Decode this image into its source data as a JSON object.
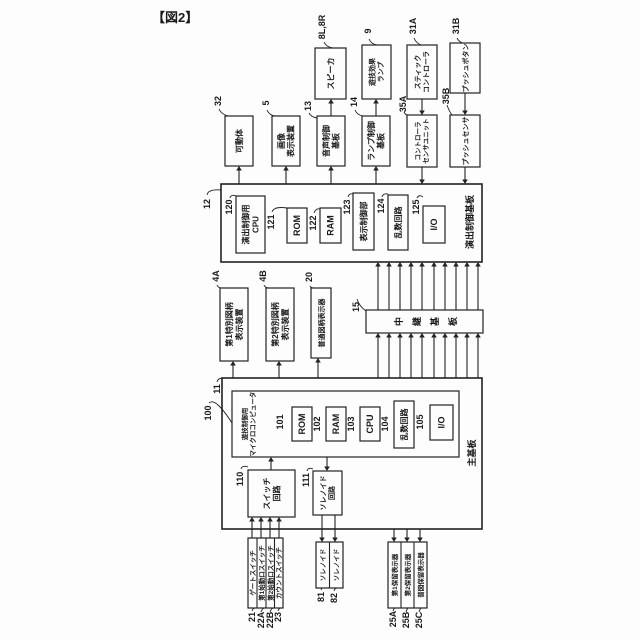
{
  "title": "【図2】",
  "nodes": {
    "speaker": {
      "ref": "8L,8R",
      "lines": [
        "スピーカ"
      ]
    },
    "effect_lamp": {
      "ref": "9",
      "lines": [
        "遊技効果",
        "ランプ"
      ]
    },
    "stick_controller": {
      "ref": "31A",
      "lines": [
        "スティック",
        "コントローラ"
      ]
    },
    "push_button": {
      "ref": "31B",
      "lines": [
        "プッシュボタン"
      ]
    },
    "movable_body": {
      "ref": "32",
      "lines": [
        "可動体"
      ]
    },
    "image_display": {
      "ref": "5",
      "lines": [
        "画像",
        "表示装置"
      ]
    },
    "sound_board": {
      "ref": "13",
      "lines": [
        "音声制御",
        "基板"
      ]
    },
    "lamp_board": {
      "ref": "14",
      "lines": [
        "ランプ制御",
        "基板"
      ]
    },
    "controller_sensor": {
      "ref": "35A",
      "lines": [
        "コントローラ",
        "センサユニット"
      ]
    },
    "push_sensor": {
      "ref": "35B",
      "lines": [
        "プッシュセンサ"
      ]
    },
    "effect_board": {
      "ref": "12",
      "label": "演出制御基板"
    },
    "effect_cpu": {
      "ref": "120",
      "lines": [
        "演出制御用",
        "CPU"
      ]
    },
    "rom121": {
      "ref": "121",
      "label": "ROM"
    },
    "ram122": {
      "ref": "122",
      "label": "RAM"
    },
    "display_ctrl": {
      "ref": "123",
      "label": "表示制御部"
    },
    "random124": {
      "ref": "124",
      "label": "乱数回路"
    },
    "io125": {
      "ref": "125",
      "label": "I/O"
    },
    "sp1_display": {
      "ref": "4A",
      "lines": [
        "第1特別図柄",
        "表示装置"
      ]
    },
    "sp2_display": {
      "ref": "4B",
      "lines": [
        "第2特別図柄",
        "表示装置"
      ]
    },
    "normal_display": {
      "ref": "20",
      "label": "普通図柄表示器"
    },
    "relay_board": {
      "ref": "15",
      "label": "中継基板"
    },
    "main_board": {
      "ref": "11",
      "label": "主基板"
    },
    "game_micom": {
      "ref": "100",
      "lines": [
        "遊技制御用",
        "マイクロコンピュータ"
      ]
    },
    "rom101": {
      "ref": "101",
      "label": "ROM"
    },
    "ram102": {
      "ref": "102",
      "label": "RAM"
    },
    "cpu103": {
      "ref": "103",
      "label": "CPU"
    },
    "random104": {
      "ref": "104",
      "label": "乱数回路"
    },
    "io105": {
      "ref": "105",
      "label": "I/O"
    },
    "switch_circuit": {
      "ref": "110",
      "lines": [
        "スイッチ",
        "回路"
      ]
    },
    "solenoid_circuit": {
      "ref": "111",
      "lines": [
        "ソレノイド",
        "回路"
      ]
    },
    "gate_switch": {
      "ref": "21",
      "label": "ゲートスイッチ"
    },
    "start1_switch": {
      "ref": "22A",
      "label": "第1始動口スイッチ"
    },
    "start2_switch": {
      "ref": "22B",
      "label": "第2始動口スイッチ"
    },
    "count_switch": {
      "ref": "23",
      "label": "カウントスイッチ"
    },
    "solenoid81": {
      "ref": "81",
      "label": "ソレノイド"
    },
    "solenoid82": {
      "ref": "82",
      "label": "ソレノイド"
    },
    "hold1_display": {
      "ref": "25A",
      "label": "第1保留表示器"
    },
    "hold2_display": {
      "ref": "25B",
      "label": "第2保留表示器"
    },
    "normal_hold_display": {
      "ref": "25C",
      "label": "普図保留表示器"
    }
  }
}
